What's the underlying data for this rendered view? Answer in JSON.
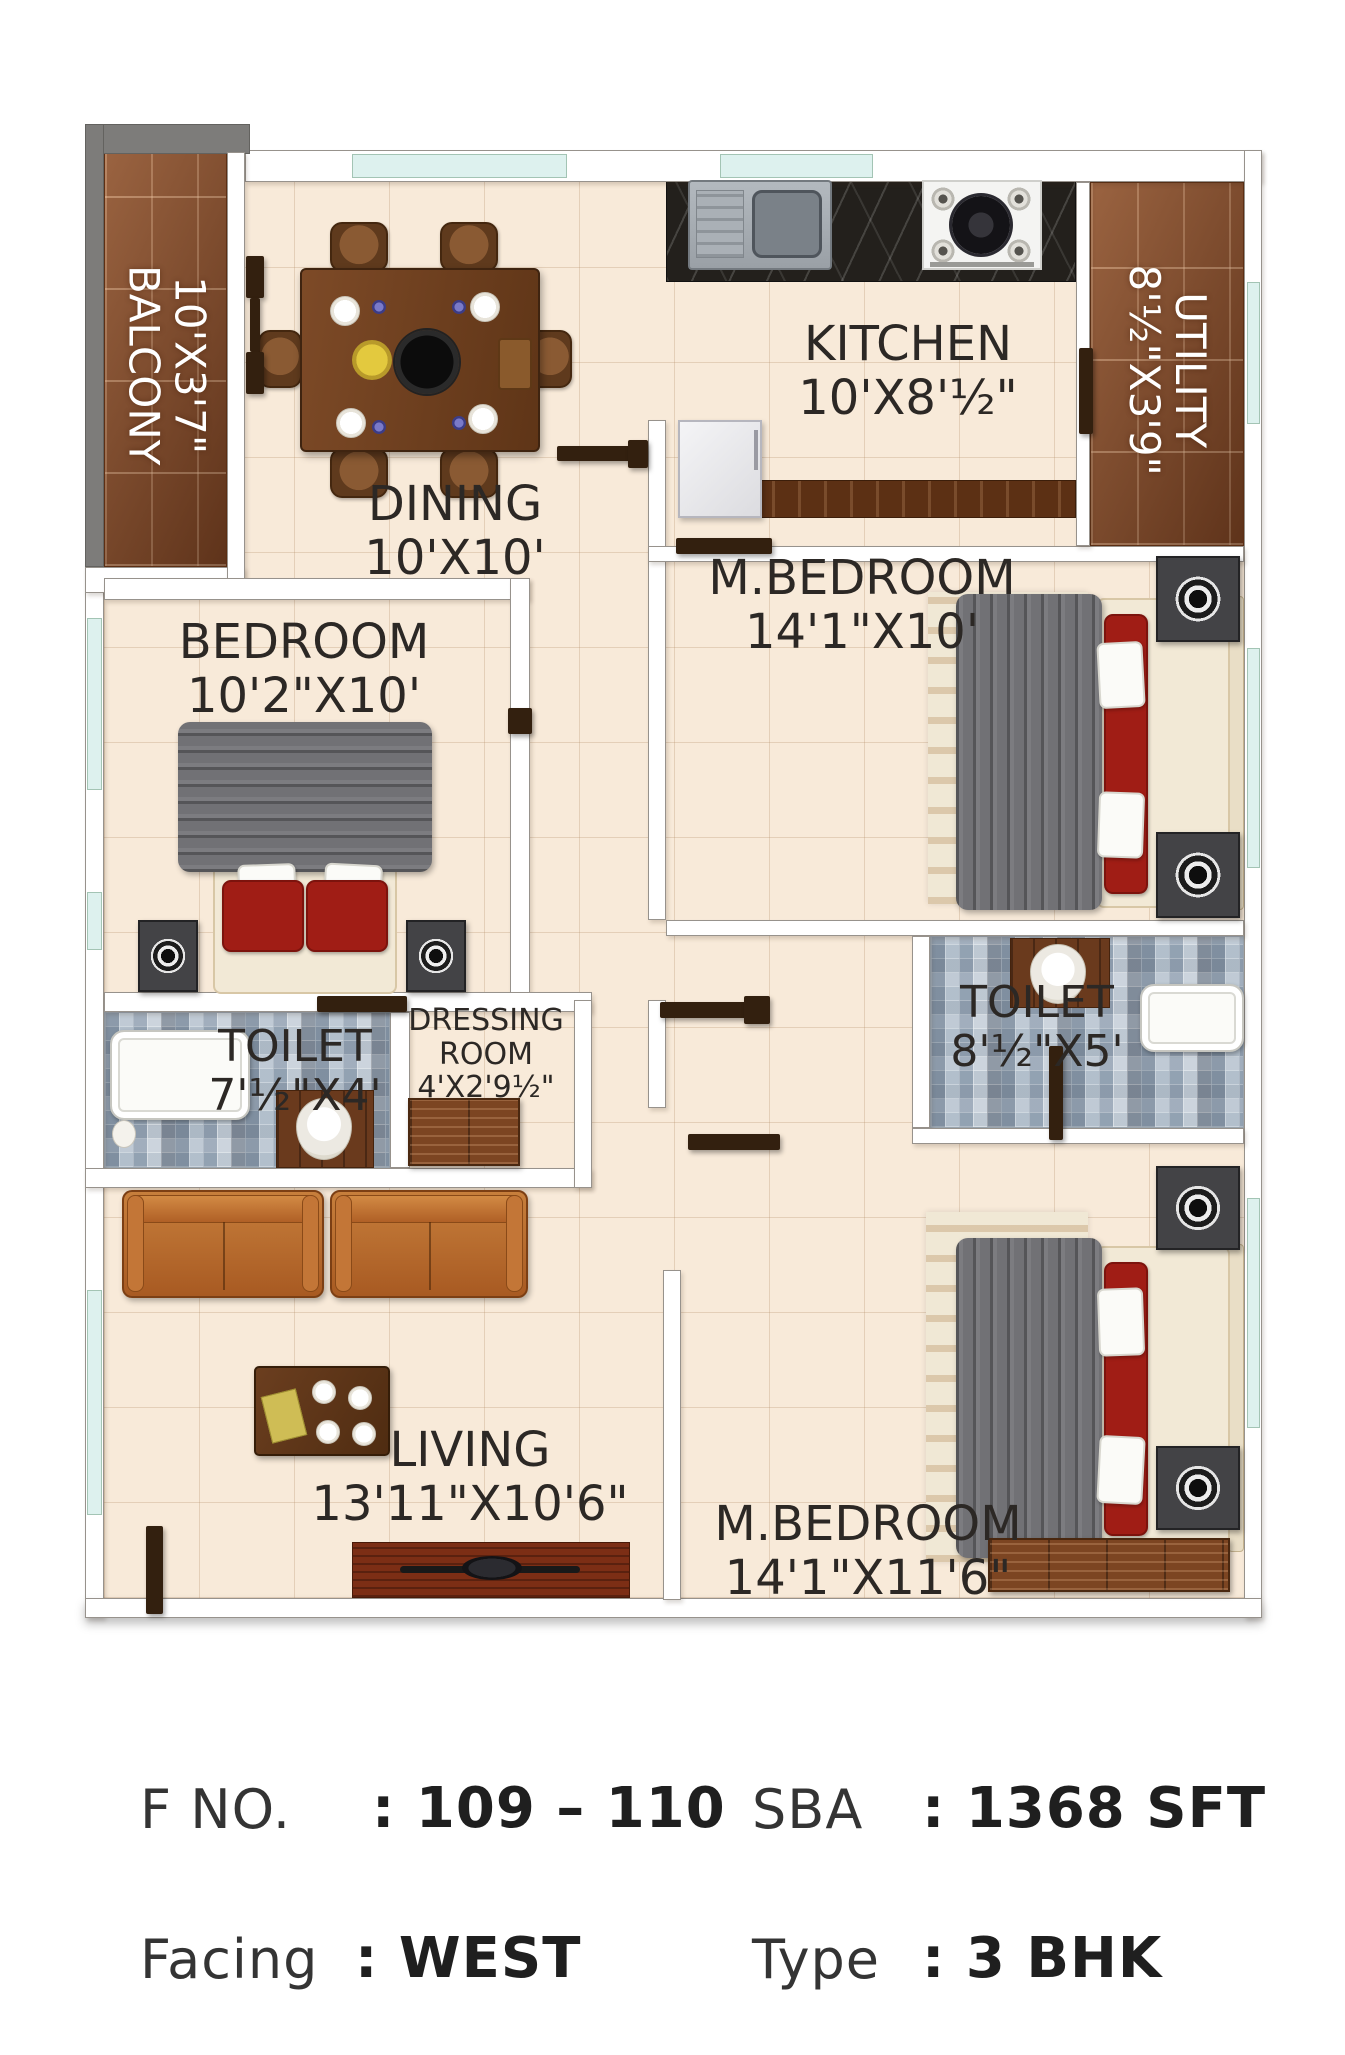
{
  "plan": {
    "rooms": [
      {
        "id": "balcony",
        "name": "BALCONY",
        "dims": "10'X3'7\""
      },
      {
        "id": "dining",
        "name": "DINING",
        "dims": "10'X10'"
      },
      {
        "id": "kitchen",
        "name": "KITCHEN",
        "dims": "10'X8'½\""
      },
      {
        "id": "utility",
        "name": "UTILITY",
        "dims": "8'½\"X3'9\""
      },
      {
        "id": "master-bedroom-top",
        "name": "M.BEDROOM",
        "dims": "14'1\"X10'"
      },
      {
        "id": "bedroom",
        "name": "BEDROOM",
        "dims": "10'2\"X10'"
      },
      {
        "id": "toilet-left",
        "name": "TOILET",
        "dims": "7'½\"X4'"
      },
      {
        "id": "dressing-room",
        "name": "DRESSING ROOM",
        "dims": "4'X2'9½\""
      },
      {
        "id": "toilet-right",
        "name": "TOILET",
        "dims": "8'½\"X5'"
      },
      {
        "id": "living",
        "name": "LIVING",
        "dims": "13'11\"X10'6\""
      },
      {
        "id": "master-bedroom-bottom",
        "name": "M.BEDROOM",
        "dims": "14'1\"X11'6\""
      }
    ],
    "colors": {
      "floor": "#f8ead9",
      "wood": "#7e4423",
      "glass": "#ddf1ee",
      "door": "#33200f",
      "mosaic": "#cdd6de",
      "counter": "#23201c",
      "sofa": "#b2662c",
      "blanket": "#717175",
      "pillow": "#a01d15",
      "label": "#2c2825"
    }
  },
  "footer": {
    "flat_label": "F NO.",
    "flat_value": ": 109 – 110",
    "sba_label": "SBA",
    "sba_value": ": 1368 SFT",
    "facing_label": "Facing",
    "facing_value": ": WEST",
    "type_label": "Type",
    "type_value": ": 3 BHK"
  }
}
